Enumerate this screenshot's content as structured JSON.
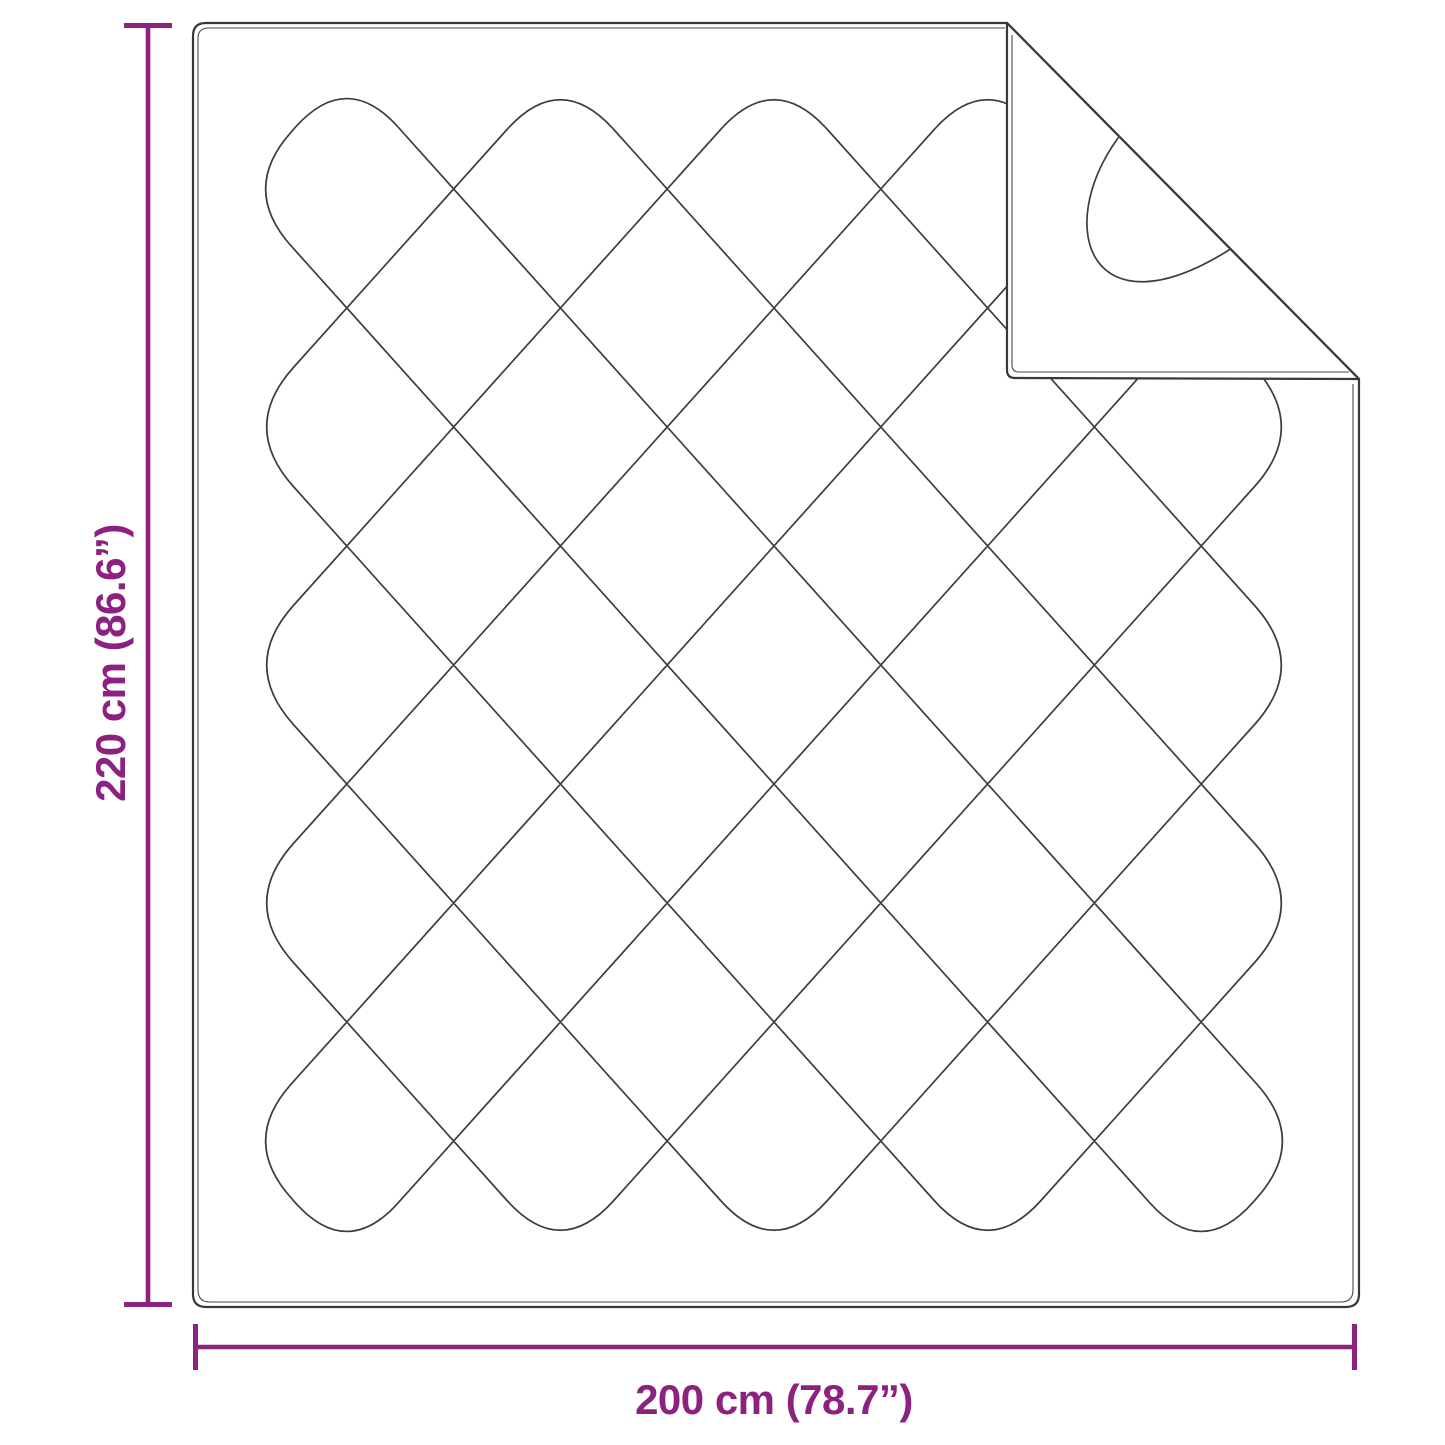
{
  "diagram": {
    "type": "product-size-diagram",
    "object": "quilted blanket with folded corner",
    "colors": {
      "dimension_accent": "#8d2180",
      "outline": "#383838",
      "stitch": "#3d3d3d",
      "background": "#ffffff"
    },
    "dimensions": {
      "height": {
        "label": "220 cm (86.6”)",
        "value_cm": 220,
        "value_inch": 86.6
      },
      "width": {
        "label": "200 cm (78.7”)",
        "value_cm": 200,
        "value_inch": 78.7
      }
    }
  }
}
